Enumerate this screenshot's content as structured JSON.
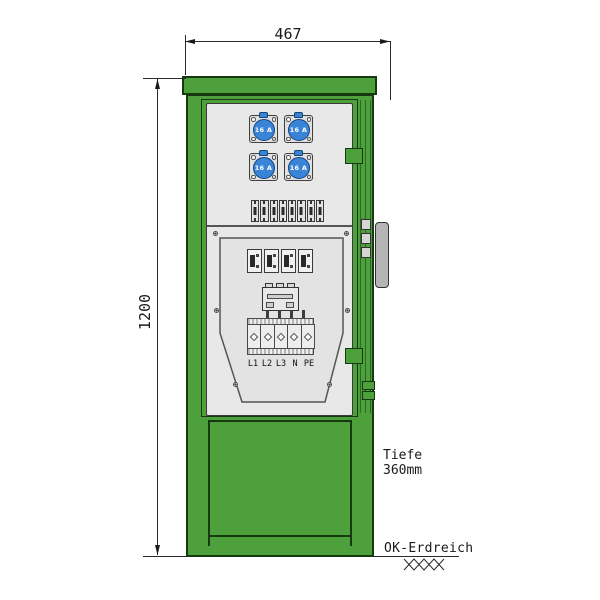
{
  "dimensions": {
    "width": "467",
    "height": "1200",
    "depth_line1": "Tiefe",
    "depth_line2": "360mm",
    "ground_level": "OK-Erdreich"
  },
  "sockets": [
    {
      "label": "16 A"
    },
    {
      "label": "16 A"
    },
    {
      "label": "16 A"
    },
    {
      "label": "16 A"
    }
  ],
  "terminals": {
    "labels": [
      "L1",
      "L2",
      "L3",
      "N",
      "PE"
    ]
  },
  "colors": {
    "cabinet_green": "#4da03c",
    "outline_green": "#153a10",
    "socket_blue": "#3a84d8",
    "socket_blue_dark": "#16447c",
    "panel_gray": "#e8e8e8",
    "handle_gray": "#b5b5b5"
  }
}
